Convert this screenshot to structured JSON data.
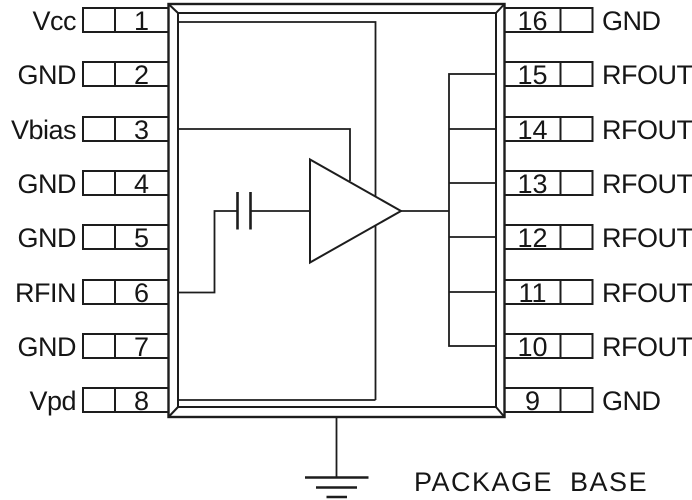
{
  "package": {
    "base_label": "PACKAGE BASE"
  },
  "colors": {
    "background": "#ffffff",
    "line": "#1d1d1d",
    "text": "#161616"
  },
  "symbols": {
    "amplifier": "rf-amplifier-triangle-icon",
    "capacitor": "dc-blocking-capacitor-icon",
    "ground": "earth-ground-icon"
  },
  "pins": {
    "left": [
      {
        "number": "1",
        "label": "Vcc"
      },
      {
        "number": "2",
        "label": "GND"
      },
      {
        "number": "3",
        "label": "Vbias"
      },
      {
        "number": "4",
        "label": "GND"
      },
      {
        "number": "5",
        "label": "GND"
      },
      {
        "number": "6",
        "label": "RFIN"
      },
      {
        "number": "7",
        "label": "GND"
      },
      {
        "number": "8",
        "label": "Vpd"
      }
    ],
    "right": [
      {
        "number": "16",
        "label": "GND"
      },
      {
        "number": "15",
        "label": "RFOUT"
      },
      {
        "number": "14",
        "label": "RFOUT"
      },
      {
        "number": "13",
        "label": "RFOUT"
      },
      {
        "number": "12",
        "label": "RFOUT"
      },
      {
        "number": "11",
        "label": "RFOUT"
      },
      {
        "number": "10",
        "label": "RFOUT"
      },
      {
        "number": "9",
        "label": "GND"
      }
    ]
  }
}
